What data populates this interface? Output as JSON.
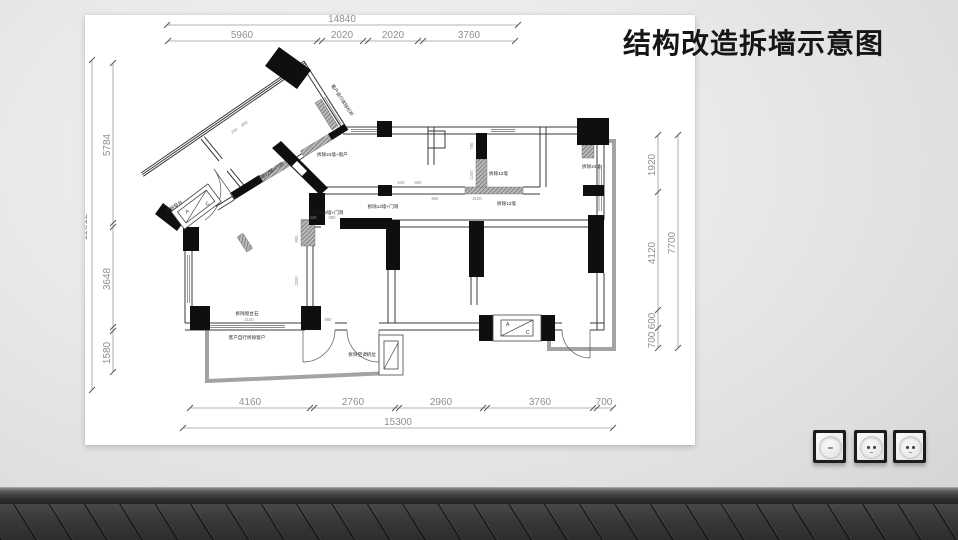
{
  "title": "结构改造拆墙示意图",
  "plan": {
    "dims_top": {
      "total": "14840",
      "seg0": "5960",
      "seg1": "2020",
      "seg2": "2020",
      "seg3": "3760"
    },
    "dims_bottom": {
      "total": "15300",
      "seg0": "4160",
      "seg1": "2760",
      "seg2": "2960",
      "seg3": "3760",
      "seg4": "700"
    },
    "dims_left": {
      "total": "11012",
      "seg0": "5784",
      "seg1": "3648",
      "seg2": "1580"
    },
    "dims_right": {
      "total": "7700",
      "seg0": "1920",
      "seg1": "4120",
      "seg2": "600",
      "seg3": "700"
    },
    "labels": {
      "demolish_12_door_a": "拆除12墙+门洞",
      "client_railing": "客户自行拆除栏杆",
      "demolish_24_window": "拆除24墙+窗户",
      "demolish_12_a": "拆除12墙",
      "demolish_12_b": "拆除12墙",
      "demolish_12_door_b": "拆除12墙+门洞",
      "demolish_24": "拆除24墙",
      "demolish_24_door": "拆除24墙+门洞",
      "demolish_sill_stone": "拆除窗台石",
      "client_window": "客户自行拆除窗户",
      "demolish_ac_position": "拆除空调机位",
      "demolish_sill": "拆除窗台",
      "ac_a": "A",
      "ac_c": "C"
    },
    "inner_dims": {
      "d780": "780",
      "d1200": "1200",
      "d660": "660",
      "d2100a": "2100",
      "d540": "540",
      "d600": "600",
      "d440": "440",
      "d880a": "880",
      "d800": "800",
      "d2200": "2200",
      "d2100b": "2100",
      "d880b": "880",
      "d240": "240",
      "d800b": "800"
    }
  },
  "outlets": [
    {
      "type": "dimmer-plate"
    },
    {
      "type": "socket"
    },
    {
      "type": "socket"
    }
  ]
}
